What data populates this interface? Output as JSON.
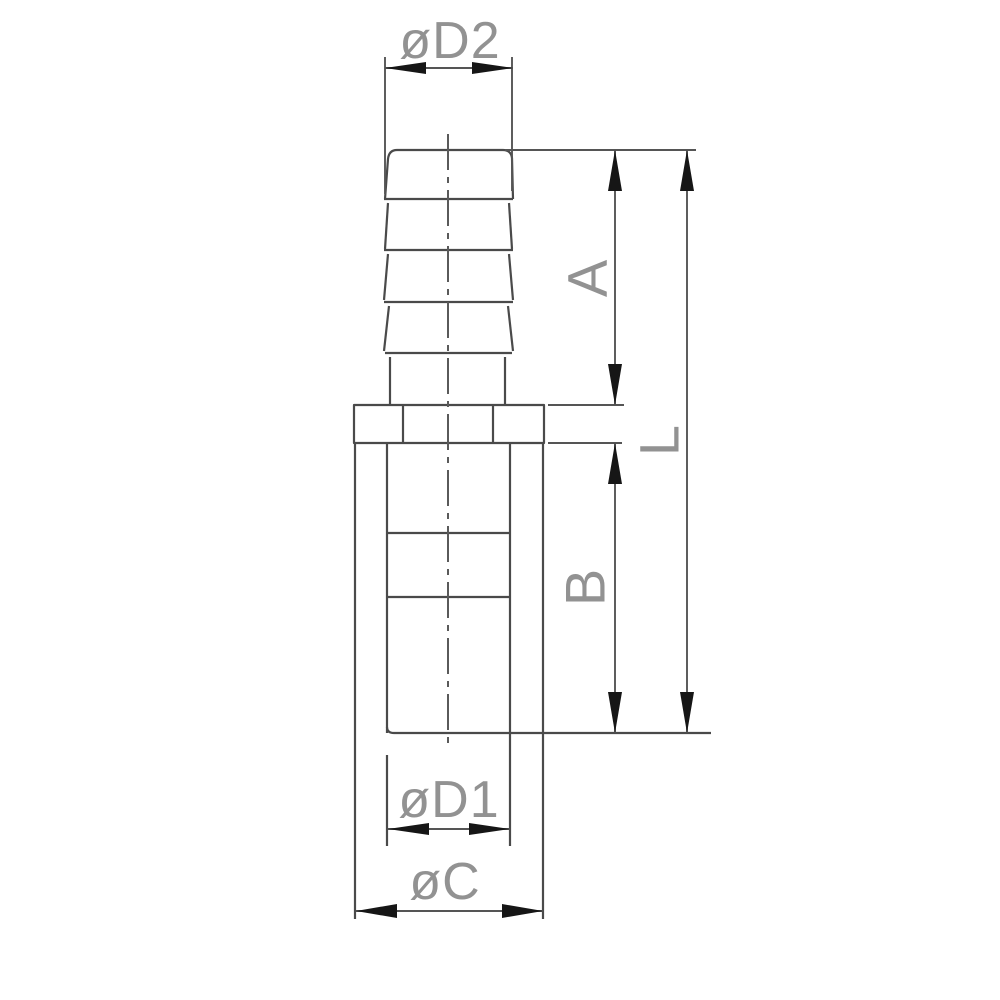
{
  "drawing": {
    "labels": {
      "d2": "øD2",
      "a": "A",
      "l": "L",
      "b": "B",
      "d1": "øD1",
      "c": "øC"
    },
    "colors": {
      "background": "#ffffff",
      "line": "#4a4a4a",
      "arrow": "#161616",
      "label": "#929292"
    }
  }
}
